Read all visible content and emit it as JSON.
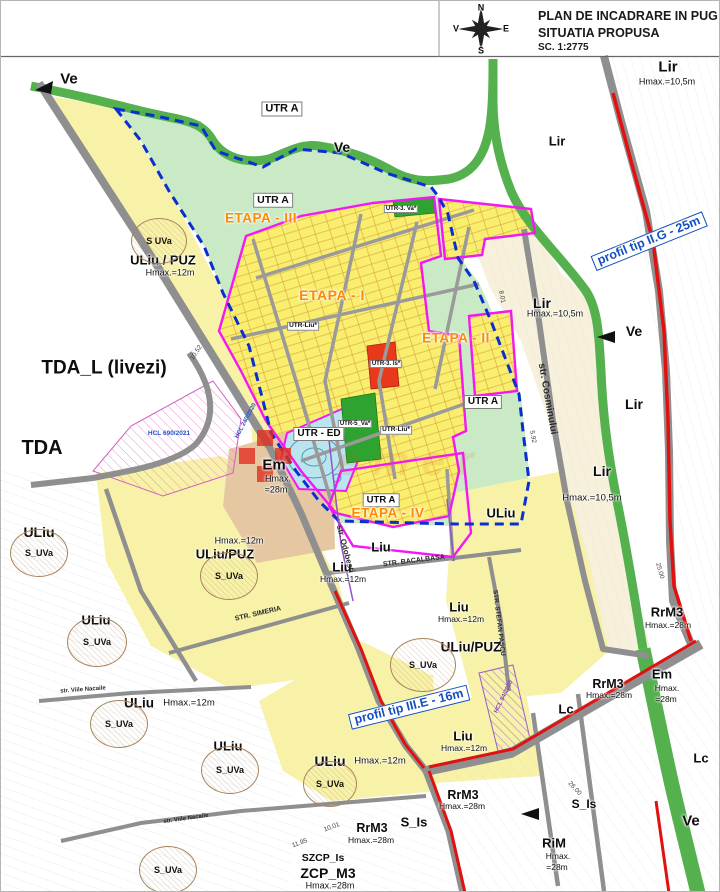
{
  "title_block": {
    "line1": "PLAN DE  INCADRARE IN PUG",
    "line2": "SITUATIA PROPUSA",
    "line3": "SC. 1:2775"
  },
  "compass": {
    "n": "N",
    "s": "S",
    "v": "V",
    "e": "E"
  },
  "zones": [
    {
      "t": "Lir",
      "sub": "Hmax.=10,5m"
    },
    {
      "t": "Lir"
    },
    {
      "t": "UTR A"
    },
    {
      "t": "ETAPA - III"
    },
    {
      "t": "ULiu / PUZ",
      "sub": "Hmax.=12m"
    },
    {
      "t": "ETAPA - I"
    },
    {
      "t": "Lir",
      "sub": "Hmax.=10,5m"
    },
    {
      "t": "ETAPA - II"
    },
    {
      "t": "TDA_L (livezi)"
    },
    {
      "t": "UTR A"
    },
    {
      "t": "Lir"
    },
    {
      "t": "UTR A"
    },
    {
      "t": "UTR - ED"
    },
    {
      "t": "TDA"
    },
    {
      "t": "Em",
      "sub": "Hmax.",
      "sub2": "=28m"
    },
    {
      "t": "Lir",
      "sub": "Hmax.=10,5m"
    },
    {
      "t": "UTR A"
    },
    {
      "t": "ETAPA - IV"
    },
    {
      "t": "ULiu"
    },
    {
      "t": "Liu"
    },
    {
      "t": "ULiu"
    },
    {
      "t": "Liu",
      "sub": "Hmax.=12m"
    },
    {
      "t": "ULiu/PUZ",
      "sub": "Hmax.=12m"
    },
    {
      "t": "Liu",
      "sub": "Hmax.=12m"
    },
    {
      "t": "ULiu/PUZ"
    },
    {
      "t": "ULiu"
    },
    {
      "t": "ULiu",
      "sub": "Hmax.=12m"
    },
    {
      "t": "ULiu"
    },
    {
      "t": "RrM3",
      "sub": "Hmax.=28m"
    },
    {
      "t": "Em",
      "sub": "Hmax.",
      "sub2": "=28m"
    },
    {
      "t": "Lc"
    },
    {
      "t": "RrM3",
      "sub": "Hmax.=28m"
    },
    {
      "t": "Liu",
      "sub": "Hmax.=12m"
    },
    {
      "t": "ULiu",
      "sub": "Hmax.=12m"
    },
    {
      "t": "Lc"
    },
    {
      "t": "Ve"
    },
    {
      "t": "RrM3",
      "sub": "Hmax.=28m"
    },
    {
      "t": "S_Is"
    },
    {
      "t": "S_Is"
    },
    {
      "t": "RiM",
      "sub": "Hmax.",
      "sub2": "=28m"
    },
    {
      "t": "RrM3",
      "sub": "Hmax.=28m"
    },
    {
      "t": "SZCP_Is"
    },
    {
      "t": "ZCP_M3",
      "sub": "Hmax.=28m"
    },
    {
      "t": "Ve"
    },
    {
      "t": "Ve"
    },
    {
      "t": "Ve"
    }
  ],
  "parcels": [
    {
      "t": "UTR-Liu*"
    },
    {
      "t": "UTR-Liu*"
    },
    {
      "t": "UTR-3. Va*"
    },
    {
      "t": "UTR-3. Is*"
    },
    {
      "t": "UTR-5_Va*"
    }
  ],
  "streets": [
    {
      "t": "str. Cosminului"
    },
    {
      "t": "STR. BACALBASA"
    },
    {
      "t": "STR. SIMERIA"
    },
    {
      "t": "STR. STEFAN PASCU"
    },
    {
      "t": "str. Odobesti"
    },
    {
      "t": "str. Viile Nacaile"
    },
    {
      "t": "str. Viile Nacaile"
    }
  ],
  "profiles": [
    {
      "t": "profil tip II.G - 25m"
    },
    {
      "t": "profil tip III.E - 16m"
    }
  ],
  "hcl": [
    {
      "t": "HCL 690/2021"
    },
    {
      "t": "HCL 240/2020"
    },
    {
      "t": "HCL 84/2020"
    }
  ],
  "suva": [
    {
      "t": "S  UVa"
    },
    {
      "t": "S_UVa"
    },
    {
      "t": "S_UVa"
    },
    {
      "t": "S_UVa"
    },
    {
      "t": "S_UVa"
    },
    {
      "t": "S_UVa"
    },
    {
      "t": "S_UVa"
    },
    {
      "t": "S_UVa"
    },
    {
      "t": "S_UVa"
    }
  ],
  "dims": [
    {
      "t": "10.52"
    },
    {
      "t": "8.01"
    },
    {
      "t": "5.92"
    },
    {
      "t": "25.00"
    },
    {
      "t": "10.01"
    },
    {
      "t": "11.95"
    },
    {
      "t": "26.00"
    }
  ],
  "watermark": {
    "t": "emer"
  },
  "colors": {
    "mint": "#C9EAC4",
    "parcel_yellow": "#FAEE6E",
    "pale_yellow": "#F7F2A8",
    "cream": "#F7F1DC",
    "tan": "#E5C8A2",
    "water_blue": "#B9E5EF",
    "green_belt": "#54B14E",
    "green_parcel": "#2FA32F",
    "red_parcel": "#E8391B",
    "road_red": "#E31010",
    "boundary_magenta": "#F318F3",
    "boundary_blue": "#0A2FD0",
    "stage_orange": "#FF8A00",
    "profile_blue": "#1550C0"
  }
}
